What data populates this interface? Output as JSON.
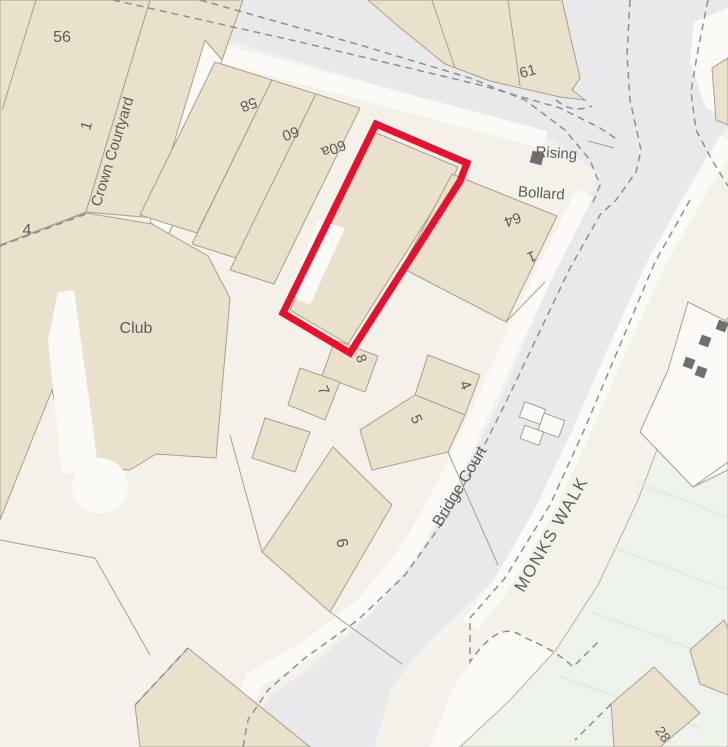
{
  "map": {
    "labels": [
      {
        "id": "no-56",
        "text": "56"
      },
      {
        "id": "no-1-crown",
        "text": "1"
      },
      {
        "id": "crown-courtyard",
        "text": "Crown Courtyard"
      },
      {
        "id": "no-4-left",
        "text": "4"
      },
      {
        "id": "no-58",
        "text": "58"
      },
      {
        "id": "no-60",
        "text": "60"
      },
      {
        "id": "no-60a",
        "text": "60a"
      },
      {
        "id": "no-61",
        "text": "61"
      },
      {
        "id": "rising",
        "text": "Rising"
      },
      {
        "id": "bollard",
        "text": "Bollard"
      },
      {
        "id": "no-64",
        "text": "64"
      },
      {
        "id": "no-1-64",
        "text": "1"
      },
      {
        "id": "club",
        "text": "Club"
      },
      {
        "id": "no-8",
        "text": "8"
      },
      {
        "id": "no-7",
        "text": "7"
      },
      {
        "id": "no-4-court",
        "text": "4"
      },
      {
        "id": "no-5",
        "text": "5"
      },
      {
        "id": "no-6",
        "text": "6"
      },
      {
        "id": "bridge-court",
        "text": "Bridge Court"
      },
      {
        "id": "monks-walk",
        "text": "MONKS WALK"
      },
      {
        "id": "no-28",
        "text": "28"
      }
    ],
    "site_boundary": {
      "color": "#e8112d"
    },
    "colors": {
      "background": "#f3f1e9",
      "road": "#e9e9ec",
      "building": "#eae1cd",
      "parcel_white": "#fbfaf7",
      "green_area": "#edf2ec",
      "label_text": "#5c5c5c",
      "dashed_boundary": "#8f8f8f",
      "bollard_marker": "#6f6f6f"
    }
  }
}
